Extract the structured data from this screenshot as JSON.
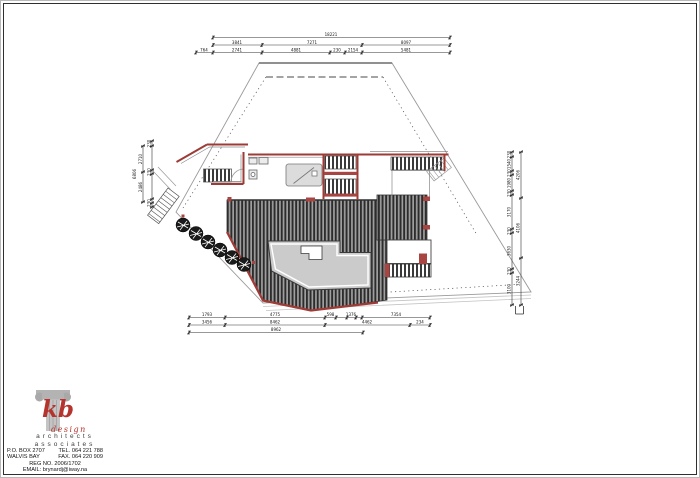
{
  "page": {
    "background": "#ffffff",
    "frame_color": "#2f2f2f"
  },
  "title_block": {
    "brand": "kb",
    "brand_sub": "design",
    "profession": "architects",
    "association": "associates",
    "po_box": "P.O. BOX 2707",
    "city": "WALVIS BAY",
    "tel": "TEL. 064 221 788",
    "fax": "FAX. 064 220 909",
    "reg": "REG NO. 2006/1702",
    "email": "EMAIL: brynardj@iway.na",
    "brand_color": "#b5342e"
  },
  "drawing": {
    "description": "site plan of house with timber deck, terrace, stairs and tree circles",
    "colors": {
      "wall": "#9e3b36",
      "wall_fill": "#a84441",
      "boundary": "#9a9a9a",
      "deck_dark": "#2c2c2c",
      "deck_light": "#9f9f9f",
      "terrace": "#cbcbcb",
      "stair_dark": "#3a3a3a"
    }
  },
  "dimensions": {
    "top": {
      "total": "18221",
      "mid": [
        "3841",
        "7271",
        "8097"
      ],
      "small": [
        "764",
        "2741",
        "4881",
        "230",
        "2154",
        "5481"
      ]
    },
    "left": {
      "total": "6806",
      "segments": [
        "230",
        "2710",
        "230",
        "2486",
        "230"
      ]
    },
    "right": {
      "inner": [
        "230",
        "1540",
        "230",
        "1980",
        "230",
        "3170",
        "230",
        "3630",
        "230",
        "3100"
      ],
      "outer": [
        "4206",
        "4106",
        "3244"
      ]
    },
    "bottom": {
      "row1": [
        "1793",
        "4775",
        "598",
        "1376",
        "7354"
      ],
      "row2": [
        "3456",
        "8462",
        "4462",
        "234"
      ],
      "total": "8962"
    }
  }
}
